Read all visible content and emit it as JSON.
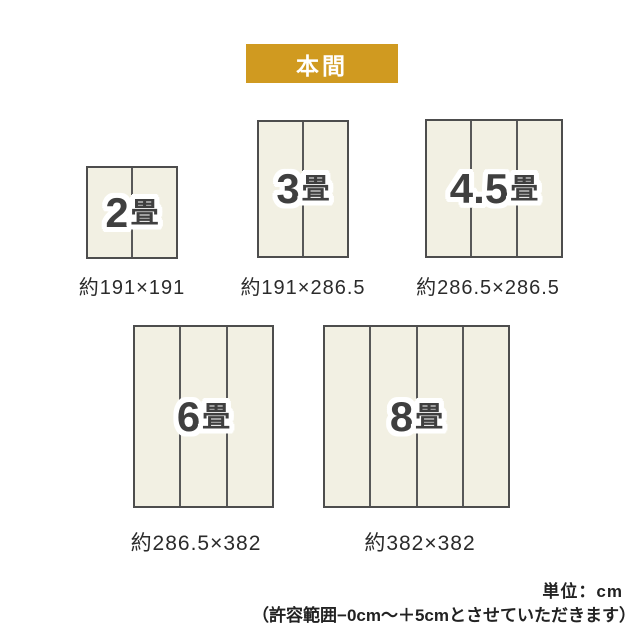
{
  "header": {
    "label": "本間"
  },
  "mats": [
    {
      "name": "2jo",
      "count": "2",
      "unit": "畳",
      "dims": "約191×191",
      "panels": 2
    },
    {
      "name": "3jo",
      "count": "3",
      "unit": "畳",
      "dims": "約191×286.5",
      "panels": 2
    },
    {
      "name": "45jo",
      "count": "4.5",
      "unit": "畳",
      "dims": "約286.5×286.5",
      "panels": 3
    },
    {
      "name": "6jo",
      "count": "6",
      "unit": "畳",
      "dims": "約286.5×382",
      "panels": 3
    },
    {
      "name": "8jo",
      "count": "8",
      "unit": "畳",
      "dims": "約382×382",
      "panels": 4
    }
  ],
  "notes": {
    "unit": "単位：cm",
    "tolerance": "（許容範囲−0cm〜＋5cmとさせていただきます）"
  },
  "colors": {
    "banner_bg": "#D09A20",
    "banner_text": "#FFFFFF",
    "mat_fill": "#F2F0E3",
    "mat_border": "#4D4D4D",
    "panel_divider": "#585858",
    "label_text": "#3F3F3F",
    "caption_text": "#2B2B2B",
    "background": "#FFFFFF"
  }
}
